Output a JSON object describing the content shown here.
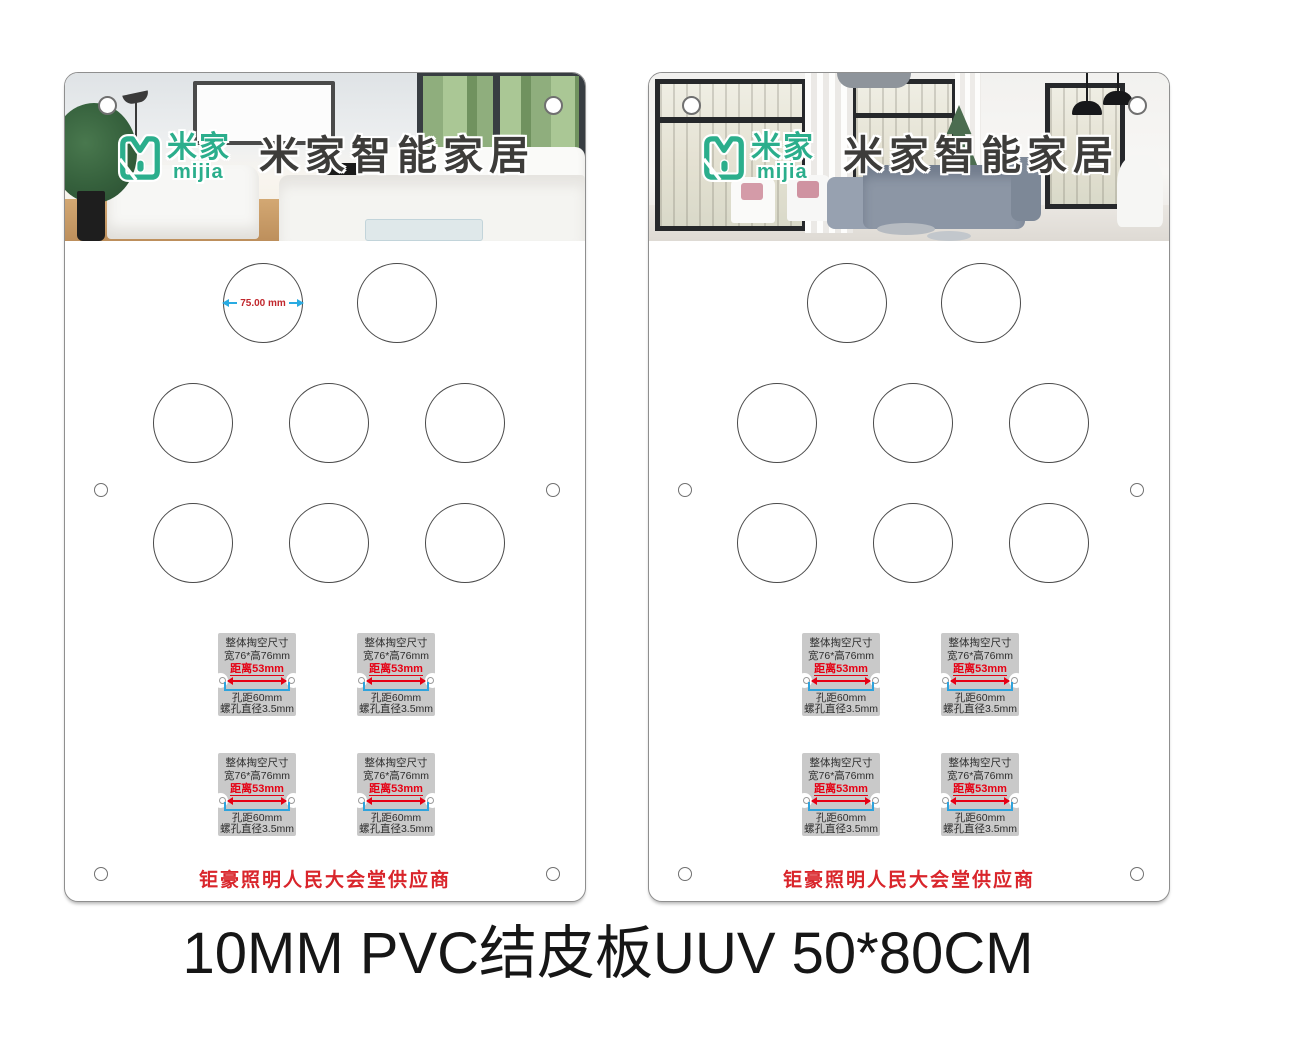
{
  "page": {
    "caption": "10MM PVC结皮板UUV 50*80CM"
  },
  "brand": {
    "logo_cn": "米家",
    "logo_en": "mijia",
    "title": "米家智能家居",
    "teal": "#2BAE8C"
  },
  "annotation": {
    "diameter": "75.00 mm"
  },
  "spec_label": {
    "line1": "整体掏空尺寸",
    "line2": "宽76*高76mm",
    "distance": "距离53mm",
    "hole_pitch": "孔距60mm",
    "screw_dia": "螺孔直径3.5mm"
  },
  "panels": [
    {
      "name": "left-board",
      "supplier": "钜豪照明人民大会堂供应商"
    },
    {
      "name": "right-board",
      "supplier": "钜豪照明人民大会堂供应商"
    }
  ],
  "colors": {
    "teal": "#2BAE8C",
    "spec_red": "#E60013",
    "supplier_red": "#D9252B",
    "dimension_blue": "#2FA3DC",
    "diameter_blue": "#29ABE2",
    "diameter_text_red": "#C1272D",
    "label_gray": "#C9C9C9",
    "cutout_outline": "#4A4A4A"
  }
}
